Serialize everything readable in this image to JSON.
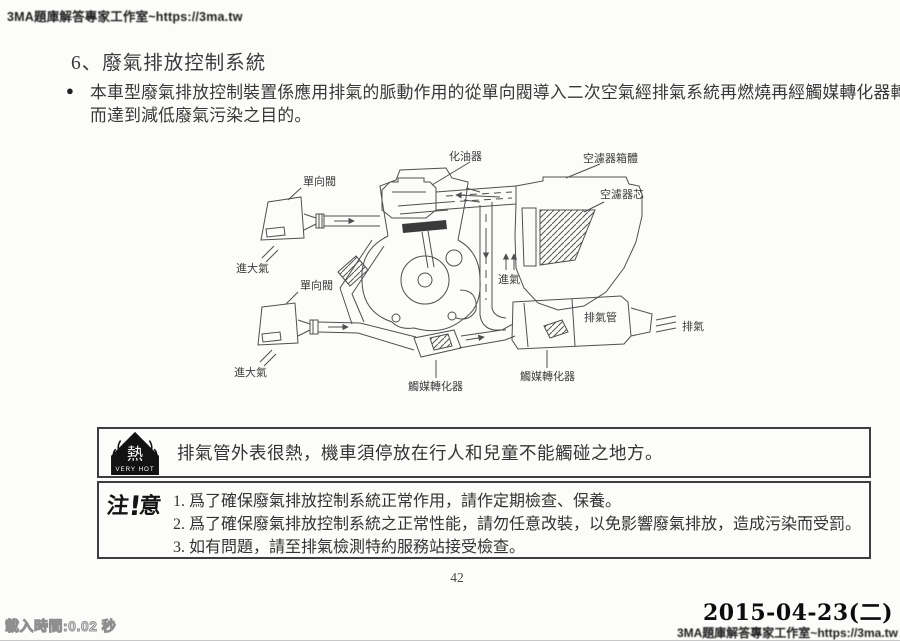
{
  "page": {
    "watermark_top": "3MA題庫解答專家工作室~https://3ma.tw",
    "watermark_bottom": "3MA題庫解答專家工作室~https://3ma.tw",
    "load_time": "載入時間:0.02 秒",
    "page_number": "42",
    "date_stamp": "2015-04-23(二)"
  },
  "section": {
    "heading": "6、廢氣排放控制系統",
    "bullet": "●",
    "body_line1": "本車型廢氣排放控制裝置係應用排氣的脈動作用的從單向閥導入二次空氣經排氣系統再燃燒再經觸媒轉化器轉化",
    "body_line2": "而達到減低廢氣污染之目的。"
  },
  "diagram": {
    "labels": {
      "carburetor": "化油器",
      "air_cleaner_case": "空濾器箱體",
      "air_cleaner_element": "空濾器芯",
      "check_valve": "單向閥",
      "air_inlet": "進大氣",
      "intake": "進氣",
      "catalytic_converter": "觸媒轉化器",
      "exhaust_pipe": "排氣管",
      "exhaust": "排氣"
    }
  },
  "hot_warning": {
    "icon_char": "熱",
    "icon_caption": "VERY HOT",
    "text": "排氣管外表很熱，機車須停放在行人和兒童不能觸碰之地方。"
  },
  "notice": {
    "icon_left": "注",
    "icon_excl": "!",
    "icon_right": "意",
    "items": [
      "1. 爲了確保廢氣排放控制系統正常作用，請作定期檢查、保養。",
      "2. 爲了確保廢氣排放控制系統之正常性能，請勿任意改裝，以免影響廢氣排放，造成污染而受罰。",
      "3. 如有問題，請至排氣檢測特約服務站接受檢查。"
    ]
  },
  "colors": {
    "paper": "#fcfcfa",
    "ink": "#2e2e2e",
    "line": "#4f4f4f"
  }
}
